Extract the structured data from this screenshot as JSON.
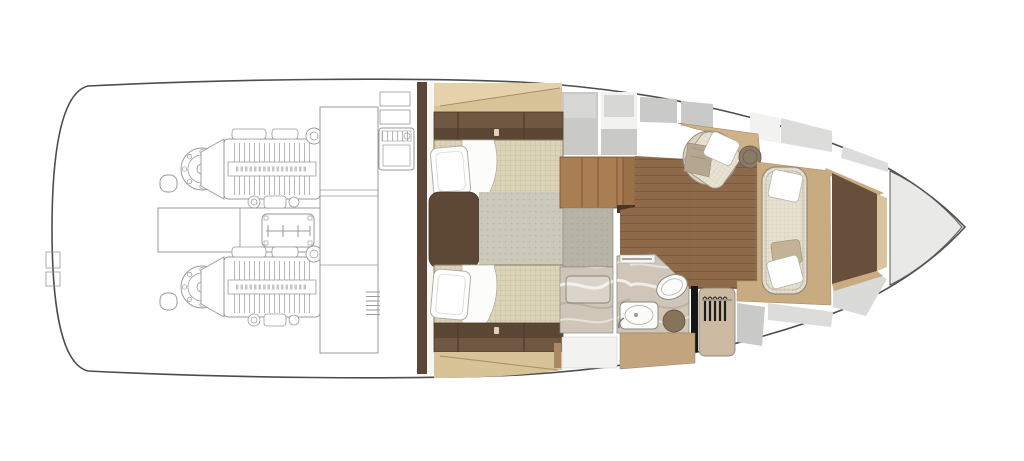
{
  "image": {
    "kind": "yacht-lower-deck-floor-plan",
    "view": "top-down",
    "orientation": "bow-right-stern-left",
    "width_px": 1024,
    "height_px": 461
  },
  "palette": {
    "hull_outline": "#4d4d4d",
    "wireframe": "#9a9a9a",
    "bulkhead": "#5b4637",
    "shelf_tan": "#d8c298",
    "shelf_tan_light": "#e5d2ac",
    "cabinet_dark": "#5c4735",
    "cabinet_light": "#6f5741",
    "cabinet_handle": "#e3d2b2",
    "mattress": "#dcd4b8",
    "pillow": "#fefefe",
    "nightstand": "#5d4836",
    "carpet": "#ccc8ba",
    "corridor": "#b7b3a5",
    "stairs_wood": "#a87e52",
    "stair_line": "#7b5833",
    "threshold": "#4a3626",
    "floor_wood": "#8e6a4b",
    "plank_line": "#6a4c32",
    "counter_tan": "#cfb289",
    "chair_fabric": "#e9e3d3",
    "chair_back": "#d9d2c0",
    "blanket": "#b5a68f",
    "side_table": "#8b7a66",
    "platform_tan": "#c8ab81",
    "sofa_fabric": "#e7e1d1",
    "sofa_pillow_tan": "#c3b295",
    "bow_block": "#684f3b",
    "bow_trim": "#d8c49e",
    "marble": "#cfc6b9",
    "marble_vein": "#a8937d",
    "fixture_white": "#fbfbf9",
    "stool_brown": "#87735a",
    "closet_tan": "#cbbaa1",
    "hanger_black": "#1c1c1c",
    "door_black": "#151515",
    "panel_gray": "#c9c9c7",
    "panel_mid": "#d7d7d5",
    "panel_light": "#dcdcda",
    "panel_white": "#f2f2f0",
    "deck_gray": "#e9e9e7",
    "vanity_tan": "#c2a57e"
  },
  "areas": [
    {
      "name": "engine-room",
      "style": "wireframe",
      "contents": [
        "port-engine",
        "starboard-engine",
        "tank-box",
        "battery-box",
        "generator",
        "service-column"
      ]
    },
    {
      "name": "guest-cabin",
      "contents": [
        "twin-bed-upper",
        "twin-bed-lower",
        "nightstand",
        "overhead-cabinets",
        "carpet"
      ]
    },
    {
      "name": "companionway",
      "contents": [
        "stairs",
        "corridor"
      ]
    },
    {
      "name": "head",
      "contents": [
        "shower",
        "toilet",
        "sink",
        "stool",
        "vanity",
        "door",
        "wardrobe-with-hangers"
      ]
    },
    {
      "name": "salon",
      "contents": [
        "teak-floor",
        "armchair",
        "throw-blanket",
        "side-table",
        "side-counter"
      ]
    },
    {
      "name": "bow-lounge",
      "contents": [
        "sofa",
        "sofa-pillows",
        "platform",
        "forward-berth-recess"
      ]
    },
    {
      "name": "bow-deck",
      "contents": []
    }
  ],
  "counts": {
    "engines": 2,
    "beds": 2,
    "pillows_on_beds": 2,
    "sofa_pillows": 3,
    "hangers": 5
  }
}
